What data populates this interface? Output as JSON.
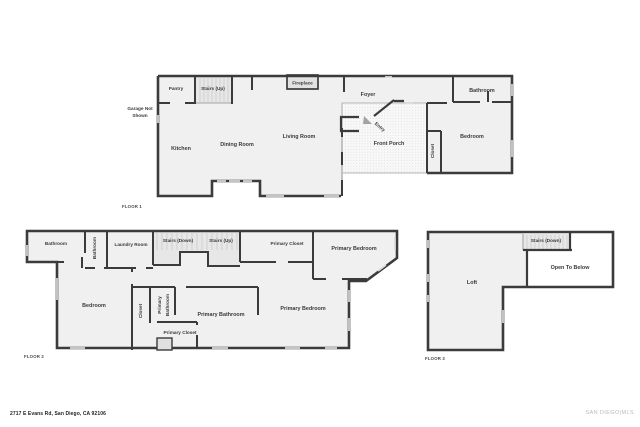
{
  "footer": {
    "address": "2717 E Evans Rd, San Diego, CA 92106",
    "brand": "SAN DIEGO|MLS"
  },
  "colors": {
    "wall": "#3b3b3b",
    "floor_fill": "#f0f0f0",
    "stairs_fill": "#e7e7e7",
    "window": "#d9d9d9",
    "porch_dot": "#cfcfcf",
    "label_text": "#3a3a3a",
    "brand_text": "#b9b9b9"
  },
  "floors": [
    {
      "label": "FLOOR 1",
      "garage_note": {
        "lines": [
          "Garage Not",
          "Shown"
        ]
      },
      "rooms": [
        {
          "name": "Pantry"
        },
        {
          "name": "Stairs (Up)"
        },
        {
          "name": "Fireplace"
        },
        {
          "name": "Foyer"
        },
        {
          "name": "Bathroom"
        },
        {
          "name": "Kitchen"
        },
        {
          "name": "Dining Room"
        },
        {
          "name": "Living Room"
        },
        {
          "name": "Entry"
        },
        {
          "name": "Front Porch"
        },
        {
          "name": "Closet"
        },
        {
          "name": "Bedroom"
        }
      ]
    },
    {
      "label": "FLOOR 2",
      "rooms": [
        {
          "name": "Bathroom"
        },
        {
          "name": "Bathroom"
        },
        {
          "name": "Laundry Room"
        },
        {
          "name": "Stairs (Down)"
        },
        {
          "name": "Stairs (Up)"
        },
        {
          "name": "Primary Closet"
        },
        {
          "name": "Primary Bedroom"
        },
        {
          "name": "Bedroom"
        },
        {
          "name": "Closet"
        },
        {
          "name": "Primary Bathroom",
          "lines": [
            "Primary",
            "Bathroom"
          ]
        },
        {
          "name": "Primary Bathroom"
        },
        {
          "name": "Primary Closet"
        },
        {
          "name": "Primary Bedroom"
        }
      ]
    },
    {
      "label": "FLOOR 3",
      "rooms": [
        {
          "name": "Stairs (Down)"
        },
        {
          "name": "Open To Below"
        },
        {
          "name": "Loft"
        }
      ]
    }
  ]
}
